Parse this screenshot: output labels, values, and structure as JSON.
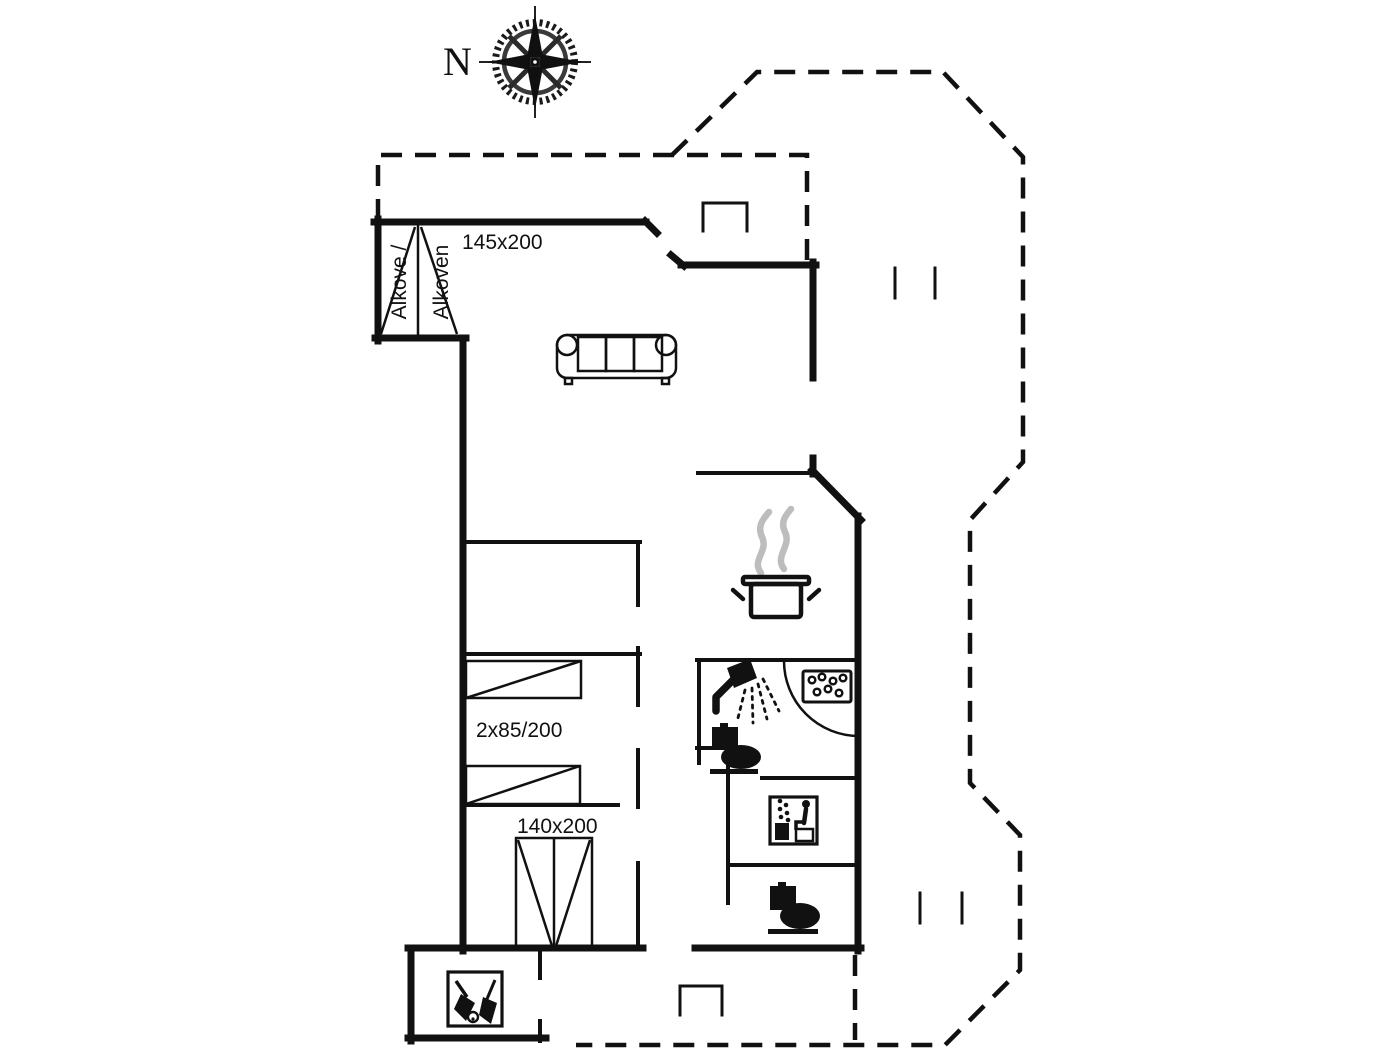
{
  "plan": {
    "background": "#ffffff",
    "line_color": "#111111",
    "steam_color": "#bdbdbd",
    "compass": {
      "north_label": "N"
    },
    "rooms": {
      "alcove": {
        "line1": "Alkove /",
        "line2": "Alkoven",
        "bed_size": "145x200"
      },
      "bedroom_singles": {
        "bed_size": "2x85/200"
      },
      "bedroom_double": {
        "bed_size": "140x200"
      }
    },
    "icons": [
      "compass-rose-icon",
      "sofa-icon",
      "cooking-pot-icon",
      "steam-icon",
      "shower-icon",
      "toilet-icon",
      "whirlpool-tub-icon",
      "sauna-icon",
      "door-swing-arc",
      "cleaning-equipment-icon",
      "alcove-bed-icon",
      "single-bed-icon",
      "double-bed-icon",
      "entrance-step-icon"
    ]
  }
}
